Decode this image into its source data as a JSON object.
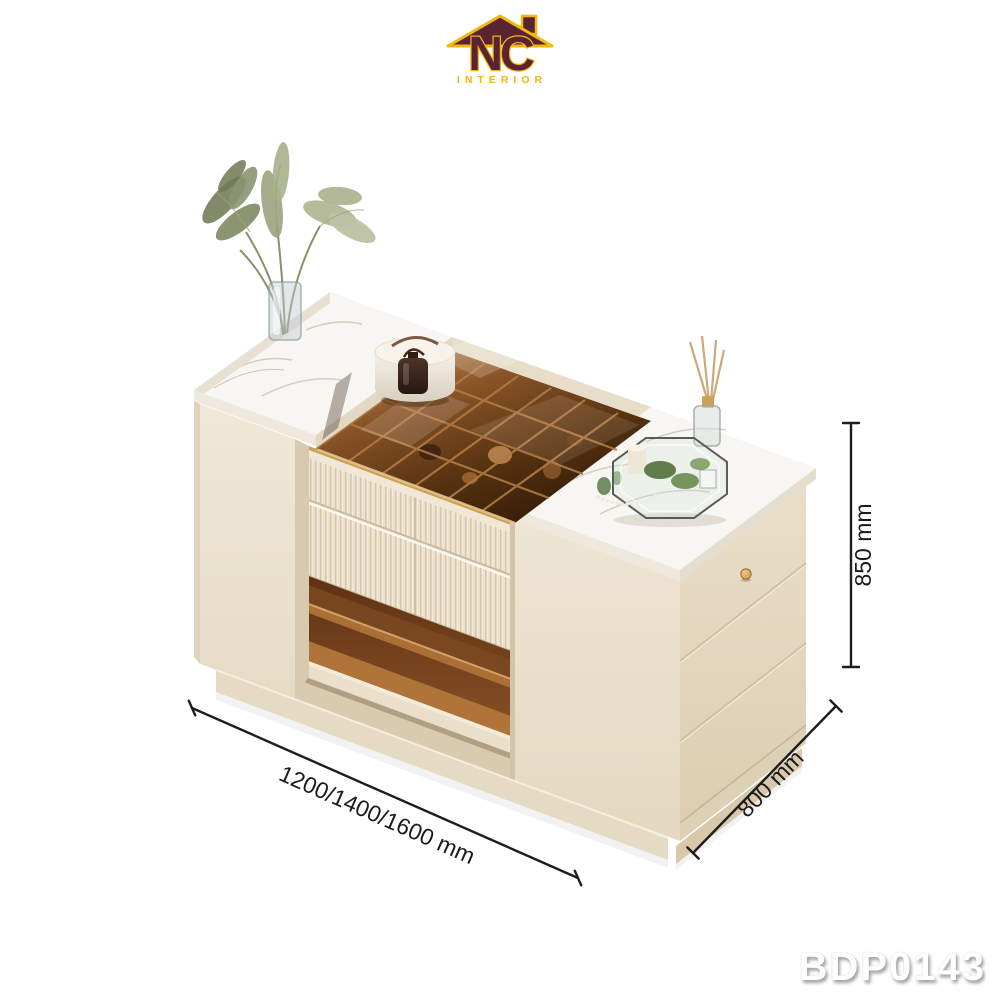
{
  "brand": {
    "monogram": "NC",
    "name": "INTERIOR",
    "maroon": "#5a2331",
    "gold": "#f2b70d"
  },
  "product": {
    "code": "BDP0143"
  },
  "annotations": {
    "width_label": "1200/1400/1600 mm",
    "depth_label": "800 mm",
    "height_label": "850 mm"
  },
  "palette": {
    "background": "#ffffff",
    "cream_light": "#f0e8d8",
    "cream_mid": "#e9dfcb",
    "cream_shadow": "#d8cab0",
    "marble_white": "#f8f6f2",
    "marble_vein": "#cfc8bd",
    "amber_glass_light": "#caa068",
    "amber_glass_mid": "#8a5427",
    "amber_glass_dark": "#331a08",
    "gold_trim": "#c9a254",
    "knob_gold": "#c9994e",
    "dimension_line": "#1d1d1d",
    "code_text": "#ffffff"
  },
  "scene": {
    "subject": "island cabinet: marble tops, amber glass wine-rack top, fluted drawers, three side drawers",
    "decor": [
      "pampas-grass-vase",
      "round-jewelry-box",
      "perfume-bottle",
      "octagon-glass-tray",
      "candle",
      "greenery",
      "reed-diffuser",
      "pearl-necklace"
    ]
  }
}
